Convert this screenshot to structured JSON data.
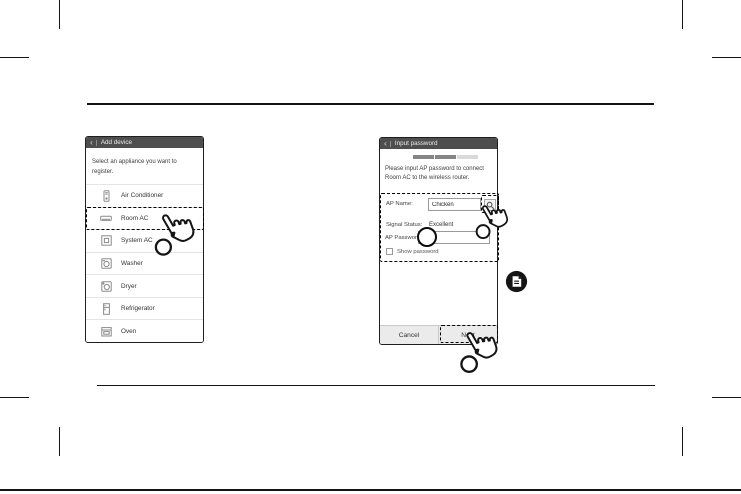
{
  "colors": {
    "page_bg": "#ffffff",
    "phone_border": "#1f1f1f",
    "header_bg": "#4e4e4e",
    "header_text": "#ededed",
    "body_text": "#3e3e3e",
    "divider": "#e4e4e4",
    "field_border": "#9a9a9a",
    "button_bar_bg": "#ebebeb",
    "progress_filled": "#868686",
    "progress_empty": "#d9d9d9",
    "annotation": "#000000"
  },
  "icons": {
    "back_glyph": "‹",
    "appliance_icons": [
      "air-conditioner-icon",
      "room-ac-icon",
      "system-ac-icon",
      "washer-icon",
      "dryer-icon",
      "refrigerator-icon",
      "oven-icon"
    ],
    "ap_name_button": "search-icon",
    "note_badge": "note-icon",
    "tap_pointer": "tap-hand-icon"
  },
  "left_phone": {
    "header": {
      "title": "Add device"
    },
    "intro": "Select an appliance you want to register.",
    "items": [
      {
        "label": "Air Conditioner"
      },
      {
        "label": "Room AC",
        "highlighted": true
      },
      {
        "label": "System AC"
      },
      {
        "label": "Washer"
      },
      {
        "label": "Dryer"
      },
      {
        "label": "Refrigerator"
      },
      {
        "label": "Oven"
      }
    ]
  },
  "right_phone": {
    "header": {
      "title": "Input password"
    },
    "progress": {
      "steps": 3,
      "completed": 2
    },
    "instruction": "Please input AP password to connect Room AC to the wireless router.",
    "form": {
      "ap_name_label": "AP Name:",
      "ap_name_value": "Chicken",
      "signal_status_label": "Signal Status:",
      "signal_status_value": "Excellent",
      "ap_password_label": "AP Password:",
      "ap_password_value": "",
      "show_password_label": "Show password",
      "show_password_checked": false
    },
    "buttons": {
      "cancel_label": "Cancel",
      "next_label": "Next",
      "next_highlighted": true
    }
  }
}
